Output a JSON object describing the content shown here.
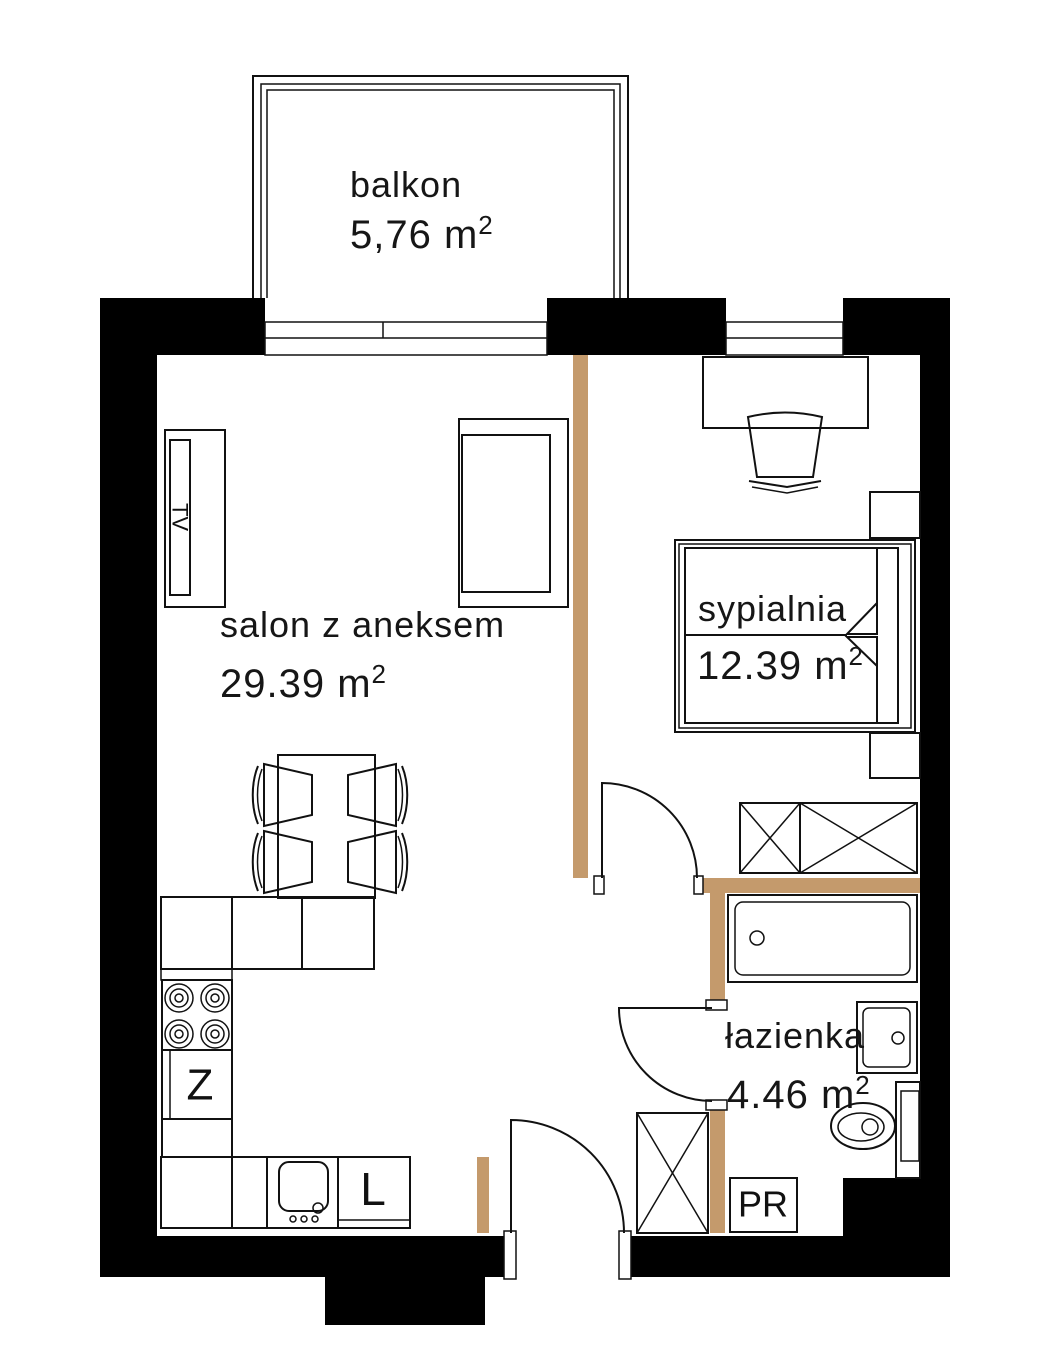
{
  "floorplan": {
    "rooms": {
      "balcony": {
        "name": "balkon",
        "area": "5,76 m",
        "area_sup": "2"
      },
      "living": {
        "name": "salon z aneksem",
        "area": "29.39 m",
        "area_sup": "2"
      },
      "bedroom": {
        "name": "sypialnia",
        "area": "12.39 m",
        "area_sup": "2"
      },
      "bathroom": {
        "name": "łazienka",
        "area": "4.46 m",
        "area_sup": "2"
      }
    },
    "fixture_labels": {
      "tv": "TV",
      "kitchen_sink": "Z",
      "fridge": "L",
      "washing_machine": "PR"
    },
    "colors": {
      "wall": "#000000",
      "partition": "#c49a6c",
      "line": "#111111",
      "background": "#ffffff"
    }
  }
}
